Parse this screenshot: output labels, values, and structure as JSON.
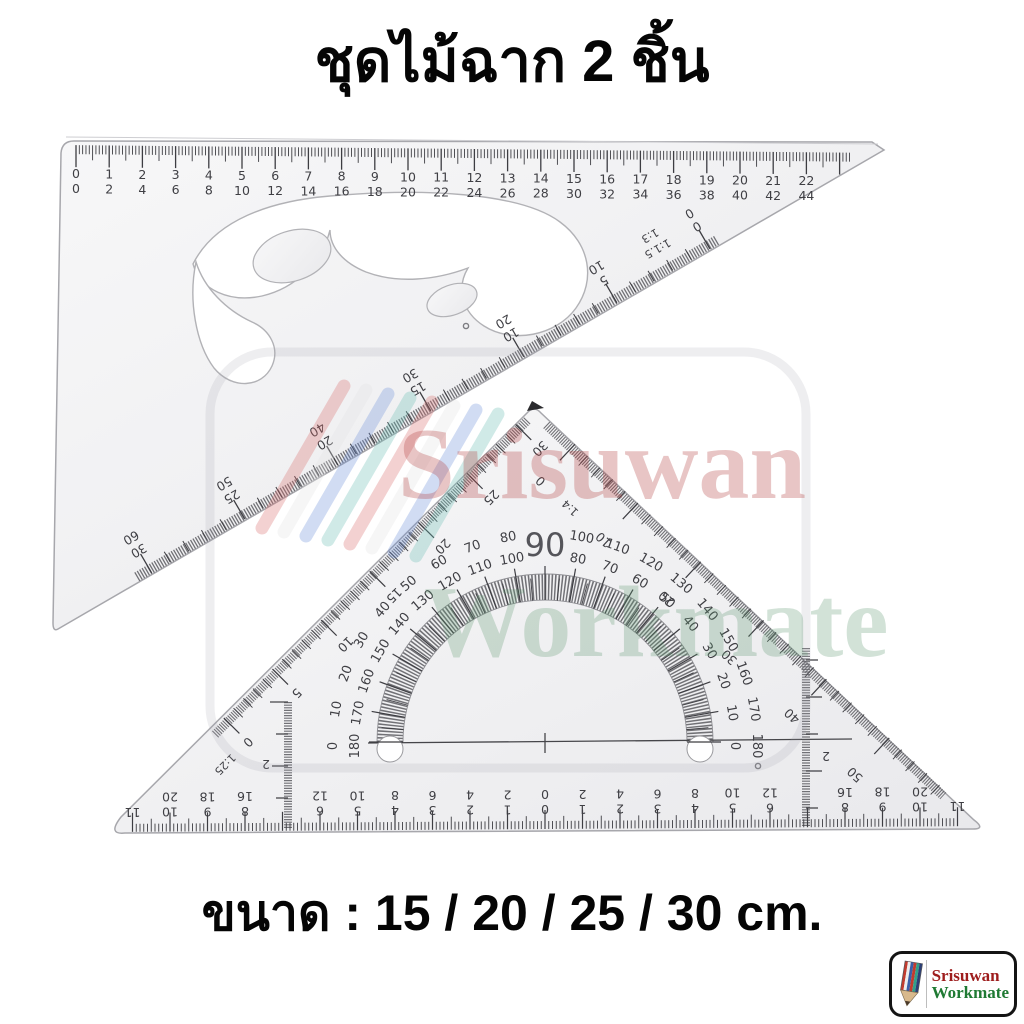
{
  "title": "ชุดไม้ฉาก 2 ชิ้น",
  "size_label": "ขนาด : 15 / 20 / 25 / 30 cm.",
  "watermark": {
    "line1": "Srisuwan",
    "line2": "Workmate"
  },
  "brand_logo": {
    "line1": "Srisuwan",
    "line2": "Workmate",
    "icon": "pencil-icon"
  },
  "ruler_30_60": {
    "name": "30-60 set square with french curve cutout",
    "top_scale": {
      "primary": [
        "0",
        "1",
        "2",
        "3",
        "4",
        "5",
        "6",
        "7",
        "8",
        "9",
        "10",
        "11",
        "12",
        "13",
        "14",
        "15",
        "16",
        "17",
        "18",
        "19",
        "20",
        "21",
        "22"
      ],
      "secondary": [
        "0",
        "2",
        "4",
        "6",
        "8",
        "10",
        "12",
        "14",
        "16",
        "18",
        "20",
        "22",
        "24",
        "26",
        "28",
        "30",
        "32",
        "34",
        "36",
        "38",
        "40",
        "42",
        "44"
      ]
    },
    "hyp_scale": {
      "names": [
        "1:1.5",
        "1:3"
      ],
      "primary": [
        "0",
        "5",
        "10",
        "15",
        "20",
        "25",
        "30"
      ],
      "secondary": [
        "0",
        "10",
        "20",
        "30",
        "40",
        "50",
        "60"
      ]
    }
  },
  "ruler_45": {
    "name": "45 set square with protractor",
    "bottom_scale": {
      "primary": [
        "11",
        "10",
        "9",
        "8",
        "7",
        "6",
        "5",
        "4",
        "3",
        "2",
        "1",
        "0",
        "1",
        "2",
        "3",
        "4",
        "5",
        "6",
        "7",
        "8",
        "9",
        "10",
        "11"
      ],
      "secondary": [
        "",
        "20",
        "18",
        "16",
        "14",
        "12",
        "10",
        "8",
        "6",
        "4",
        "2",
        "0",
        "2",
        "4",
        "6",
        "8",
        "10",
        "12",
        "14",
        "16",
        "18",
        "20",
        ""
      ]
    },
    "left_scale": {
      "name": "1:25",
      "labels": [
        "0",
        "5",
        "10",
        "15",
        "20",
        "25",
        "30"
      ]
    },
    "right_scale": {
      "name": "1:4",
      "labels": [
        "0",
        "10",
        "20",
        "30",
        "40",
        "50"
      ]
    },
    "mini_scales": {
      "left_label": "2",
      "right_label": "2"
    },
    "protractor": {
      "pairs": [
        {
          "deg": 0,
          "outer": "180",
          "inner": "0"
        },
        {
          "deg": 10,
          "outer": "170",
          "inner": "10"
        },
        {
          "deg": 20,
          "outer": "160",
          "inner": "20"
        },
        {
          "deg": 30,
          "outer": "150",
          "inner": "30"
        },
        {
          "deg": 40,
          "outer": "140",
          "inner": "40"
        },
        {
          "deg": 50,
          "outer": "130",
          "inner": "50"
        },
        {
          "deg": 60,
          "outer": "120",
          "inner": "60"
        },
        {
          "deg": 70,
          "outer": "110",
          "inner": "70"
        },
        {
          "deg": 80,
          "outer": "100",
          "inner": "80"
        },
        {
          "deg": 90,
          "outer": "90",
          "inner": ""
        },
        {
          "deg": 100,
          "outer": "80",
          "inner": "100"
        },
        {
          "deg": 110,
          "outer": "70",
          "inner": "110"
        },
        {
          "deg": 120,
          "outer": "60",
          "inner": "120"
        },
        {
          "deg": 130,
          "outer": "50",
          "inner": "130"
        },
        {
          "deg": 140,
          "outer": "40",
          "inner": "140"
        },
        {
          "deg": 150,
          "outer": "30",
          "inner": "150"
        },
        {
          "deg": 160,
          "outer": "20",
          "inner": "160"
        },
        {
          "deg": 170,
          "outer": "10",
          "inner": "170"
        },
        {
          "deg": 180,
          "outer": "0",
          "inner": "180"
        }
      ]
    }
  }
}
